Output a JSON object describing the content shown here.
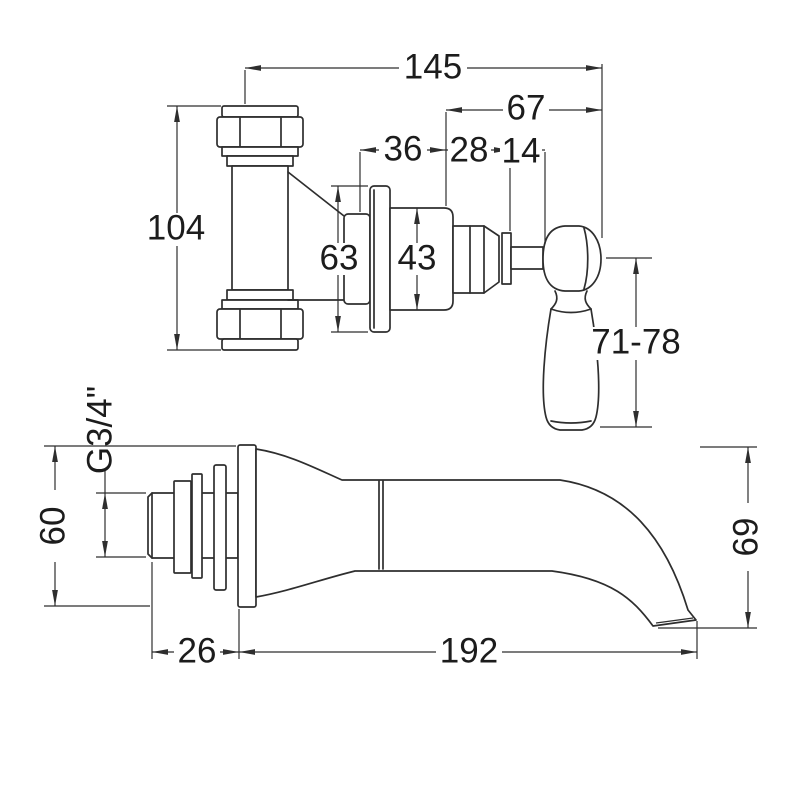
{
  "diagram": {
    "background": "#ffffff",
    "line_color": "#2e2e2e",
    "text_color": "#1c1c1c",
    "views": {
      "valve": {
        "dims": {
          "overall_width": "145",
          "handle_projection": "67",
          "flange_to_body": "36",
          "body_length": "28",
          "stem_length": "14",
          "pipe_height": "104",
          "flange_diameter": "63",
          "body_diameter": "43",
          "handle_length": "71-78"
        }
      },
      "spout": {
        "dims": {
          "thread_size": "G3/4\"",
          "wall_flange_diameter": "60",
          "tail_length": "26",
          "spout_reach": "192",
          "spout_drop": "69"
        }
      }
    }
  }
}
